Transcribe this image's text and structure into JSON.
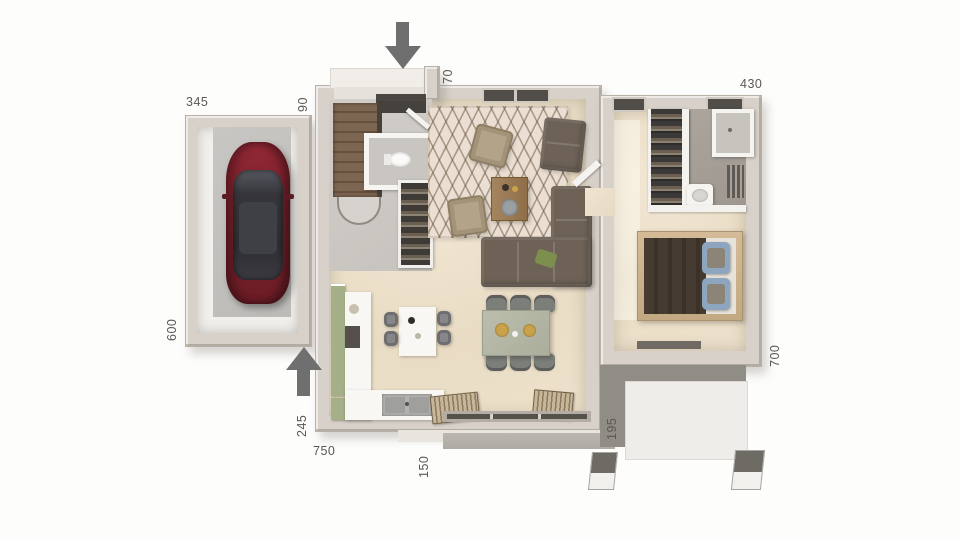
{
  "title": "3D house floor plan — top view",
  "dimensions": {
    "garage_width": "345",
    "entry_gap": "90",
    "porch_depth": "70",
    "suite_width": "430",
    "garage_depth": "600",
    "suite_depth": "700",
    "kitchen_wall": "245",
    "house_width": "750",
    "terrace_depth": "150",
    "terrace_path": "195"
  },
  "icons": {
    "entrance_top": "arrow-down",
    "entrance_side": "arrow-up"
  },
  "colors": {
    "wall": "#d7d1c9",
    "floor_beige": "#ecdfc9",
    "accent_arrow": "#6f6f6f",
    "dim_text": "#5b5751",
    "car_red": "#832230",
    "kitchen_green": "#a5b089",
    "bed_blue": "#8da5bf",
    "terrace_gray": "#908c86"
  }
}
